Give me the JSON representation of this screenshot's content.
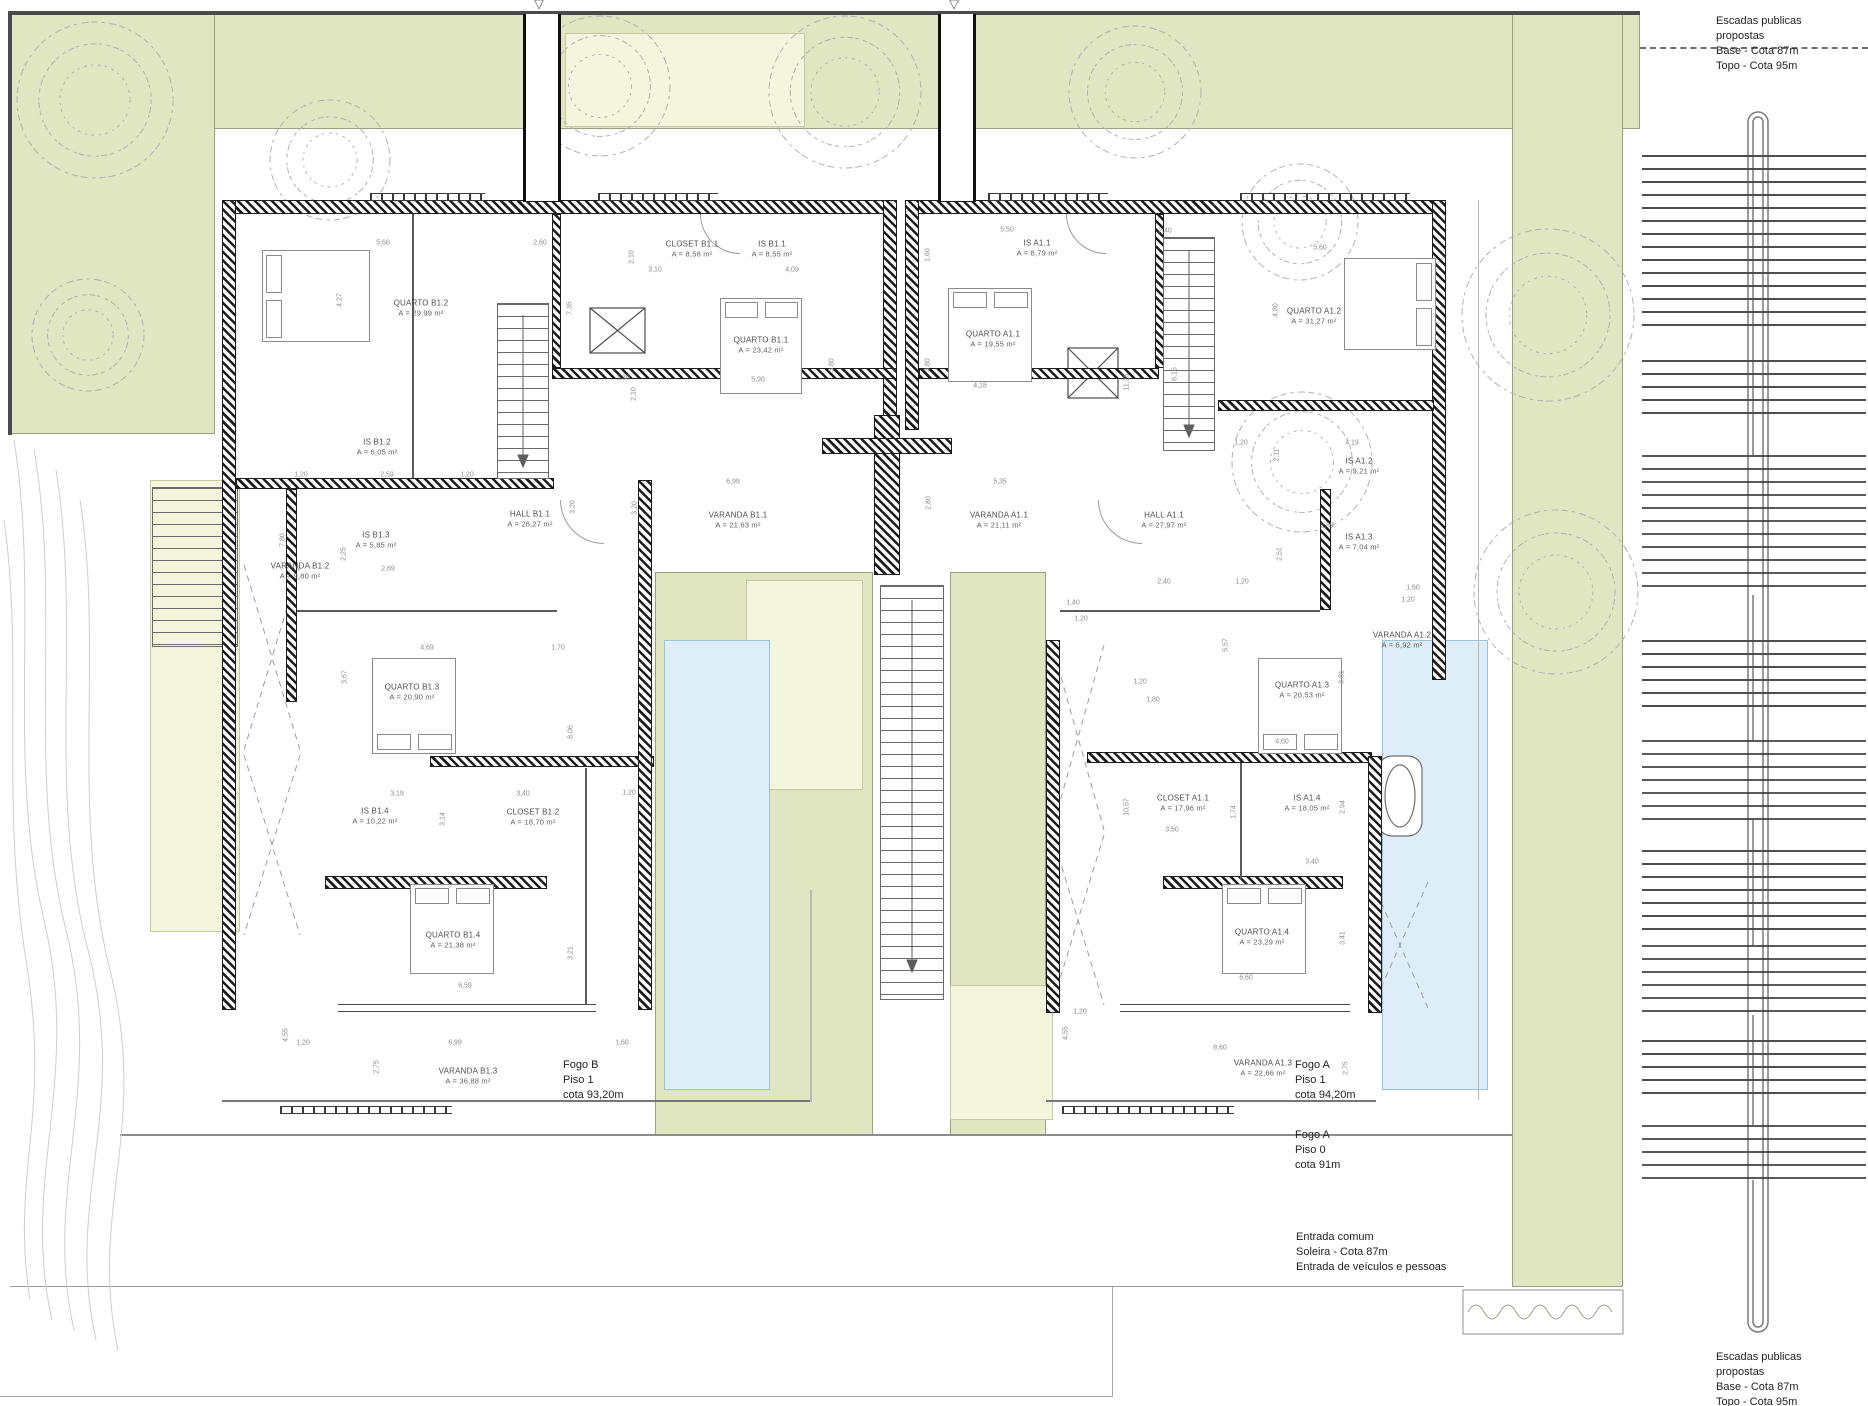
{
  "colors": {
    "garden_green": "#e0e5c2",
    "pale_green": "#f3f5dc",
    "pool_blue": "#ddeef8",
    "wall_dark": "#1d1d1d",
    "line_gray": "#6a6a6a",
    "text_gray": "#4e4e4e"
  },
  "notes": [
    {
      "id": "stairs-note-top-right",
      "x": 1716,
      "y": 14,
      "lines": [
        "Escadas publicas",
        "propostas",
        "Base - Cota 87m",
        "Topo - Cota 95m"
      ]
    },
    {
      "id": "stairs-note-bottom-right",
      "x": 1716,
      "y": 1350,
      "lines": [
        "Escadas publicas",
        "propostas",
        "Base - Cota 87m",
        "Topo - Cota 95m"
      ]
    },
    {
      "id": "fogo-b-piso-1",
      "x": 563,
      "y": 1058,
      "lines": [
        "Fogo B",
        "Piso 1",
        "cota 93,20m"
      ]
    },
    {
      "id": "fogo-a-piso-1",
      "x": 1295,
      "y": 1058,
      "lines": [
        "Fogo A",
        "Piso 1",
        "cota 94,20m"
      ]
    },
    {
      "id": "fogo-a-piso-0",
      "x": 1295,
      "y": 1128,
      "lines": [
        "Fogo A",
        "Piso 0",
        "cota 91m"
      ]
    },
    {
      "id": "entrada-comum",
      "x": 1296,
      "y": 1230,
      "lines": [
        "Entrada comum",
        "Soleira - Cota 87m",
        "Entrada de veículos e pessoas"
      ]
    }
  ],
  "rooms": [
    {
      "name": "QUARTO B1.2",
      "area": "A = 29,99 m²",
      "x": 421,
      "y": 308
    },
    {
      "name": "CLOSET B1.1",
      "area": "A = 8,56 m²",
      "x": 692,
      "y": 249
    },
    {
      "name": "IS B1.1",
      "area": "A = 8,55 m²",
      "x": 772,
      "y": 249
    },
    {
      "name": "QUARTO B1.1",
      "area": "A = 23,42 m²",
      "x": 761,
      "y": 345
    },
    {
      "name": "IS B1.2",
      "area": "A = 6,05 m²",
      "x": 377,
      "y": 447
    },
    {
      "name": "IS B1.3",
      "area": "A = 5,85 m²",
      "x": 376,
      "y": 540
    },
    {
      "name": "VARANDA B1.2",
      "area": "A = 9,80 m²",
      "x": 300,
      "y": 571
    },
    {
      "name": "HALL B1.1",
      "area": "A = 26,27 m²",
      "x": 530,
      "y": 519
    },
    {
      "name": "VARANDA B1.1",
      "area": "A = 21,63 m²",
      "x": 738,
      "y": 520
    },
    {
      "name": "QUARTO B1.3",
      "area": "A = 20,90 m²",
      "x": 412,
      "y": 692
    },
    {
      "name": "IS B1.4",
      "area": "A = 10,22 m²",
      "x": 375,
      "y": 816
    },
    {
      "name": "CLOSET B1.2",
      "area": "A = 18,70 m²",
      "x": 533,
      "y": 817
    },
    {
      "name": "QUARTO B1.4",
      "area": "A = 21,38 m²",
      "x": 453,
      "y": 940
    },
    {
      "name": "VARANDA B1.3",
      "area": "A = 36,88 m²",
      "x": 468,
      "y": 1076
    },
    {
      "name": "IS A1.1",
      "area": "A = 8,79 m²",
      "x": 1037,
      "y": 248
    },
    {
      "name": "QUARTO A1.1",
      "area": "A = 19,55 m²",
      "x": 993,
      "y": 339
    },
    {
      "name": "QUARTO A1.2",
      "area": "A = 31,27 m²",
      "x": 1314,
      "y": 316
    },
    {
      "name": "IS A1.2",
      "area": "A = 9,21 m²",
      "x": 1359,
      "y": 466
    },
    {
      "name": "HALL A1.1",
      "area": "A = 27,97 m²",
      "x": 1164,
      "y": 520
    },
    {
      "name": "VARANDA A1.1",
      "area": "A = 21,11 m²",
      "x": 999,
      "y": 520
    },
    {
      "name": "IS A1.3",
      "area": "A = 7,04 m²",
      "x": 1359,
      "y": 542
    },
    {
      "name": "VARANDA A1.2",
      "area": "A = 6,92 m²",
      "x": 1402,
      "y": 640
    },
    {
      "name": "QUARTO A1.3",
      "area": "A = 20,53 m²",
      "x": 1302,
      "y": 690
    },
    {
      "name": "CLOSET A1.1",
      "area": "A = 17,96 m²",
      "x": 1183,
      "y": 803
    },
    {
      "name": "IS A1.4",
      "area": "A = 18,05 m²",
      "x": 1307,
      "y": 803
    },
    {
      "name": "QUARTO A1.4",
      "area": "A = 23,29 m²",
      "x": 1262,
      "y": 937
    },
    {
      "name": "VARANDA A1.3",
      "area": "A = 22,66 m²",
      "x": 1263,
      "y": 1068
    }
  ],
  "dims": [
    {
      "t": "5,60",
      "x": 383,
      "y": 243
    },
    {
      "t": "2,60",
      "x": 540,
      "y": 243
    },
    {
      "t": "3,10",
      "x": 655,
      "y": 270
    },
    {
      "t": "4,09",
      "x": 792,
      "y": 270
    },
    {
      "t": "2,10",
      "x": 632,
      "y": 257,
      "v": true
    },
    {
      "t": "4,27",
      "x": 340,
      "y": 300,
      "v": true
    },
    {
      "t": "7,35",
      "x": 570,
      "y": 308,
      "v": true
    },
    {
      "t": "5,90",
      "x": 758,
      "y": 380
    },
    {
      "t": "3,80",
      "x": 832,
      "y": 365,
      "v": true
    },
    {
      "t": "1,30",
      "x": 623,
      "y": 378
    },
    {
      "t": "2,10",
      "x": 634,
      "y": 394,
      "v": true
    },
    {
      "t": "5,50",
      "x": 1007,
      "y": 230
    },
    {
      "t": "2,40",
      "x": 1165,
      "y": 231
    },
    {
      "t": "1,60",
      "x": 928,
      "y": 255,
      "v": true
    },
    {
      "t": "4,18",
      "x": 980,
      "y": 386
    },
    {
      "t": "3,80",
      "x": 928,
      "y": 365,
      "v": true
    },
    {
      "t": "11,25",
      "x": 1127,
      "y": 382,
      "v": true
    },
    {
      "t": "6,15",
      "x": 1175,
      "y": 374,
      "v": true
    },
    {
      "t": "5,60",
      "x": 1320,
      "y": 248
    },
    {
      "t": "4,80",
      "x": 1276,
      "y": 310,
      "v": true
    },
    {
      "t": "1,20",
      "x": 1241,
      "y": 443
    },
    {
      "t": "4,19",
      "x": 1352,
      "y": 443
    },
    {
      "t": "2,11",
      "x": 1277,
      "y": 455,
      "v": true
    },
    {
      "t": "1,20",
      "x": 301,
      "y": 475
    },
    {
      "t": "2,59",
      "x": 387,
      "y": 475
    },
    {
      "t": "1,20",
      "x": 467,
      "y": 475
    },
    {
      "t": "3,20",
      "x": 573,
      "y": 507,
      "v": true
    },
    {
      "t": "3,20",
      "x": 635,
      "y": 508,
      "v": true
    },
    {
      "t": "2,25",
      "x": 344,
      "y": 554,
      "v": true
    },
    {
      "t": "2,69",
      "x": 388,
      "y": 569
    },
    {
      "t": "7,80",
      "x": 283,
      "y": 540,
      "v": true
    },
    {
      "t": "4,69",
      "x": 427,
      "y": 648
    },
    {
      "t": "1,70",
      "x": 558,
      "y": 648
    },
    {
      "t": "6,99",
      "x": 733,
      "y": 482
    },
    {
      "t": "5,35",
      "x": 1000,
      "y": 482
    },
    {
      "t": "2,80",
      "x": 929,
      "y": 503,
      "v": true
    },
    {
      "t": "2,40",
      "x": 1164,
      "y": 582
    },
    {
      "t": "1,20",
      "x": 1242,
      "y": 582
    },
    {
      "t": "1,40",
      "x": 1073,
      "y": 603
    },
    {
      "t": "1,20",
      "x": 1081,
      "y": 619
    },
    {
      "t": "2,89",
      "x": 1327,
      "y": 526
    },
    {
      "t": "2,51",
      "x": 1280,
      "y": 554,
      "v": true
    },
    {
      "t": "5,57",
      "x": 1226,
      "y": 645,
      "v": true
    },
    {
      "t": "1,60",
      "x": 1413,
      "y": 588
    },
    {
      "t": "1,20",
      "x": 1408,
      "y": 600
    },
    {
      "t": "3,67",
      "x": 345,
      "y": 677,
      "v": true
    },
    {
      "t": "8,06",
      "x": 571,
      "y": 732,
      "v": true
    },
    {
      "t": "3,19",
      "x": 397,
      "y": 794
    },
    {
      "t": "3,40",
      "x": 523,
      "y": 794
    },
    {
      "t": "1,20",
      "x": 629,
      "y": 793
    },
    {
      "t": "3,14",
      "x": 443,
      "y": 819,
      "v": true
    },
    {
      "t": "6,59",
      "x": 465,
      "y": 986
    },
    {
      "t": "3,21",
      "x": 571,
      "y": 953,
      "v": true
    },
    {
      "t": "1,20",
      "x": 303,
      "y": 1043
    },
    {
      "t": "6,99",
      "x": 455,
      "y": 1043
    },
    {
      "t": "1,60",
      "x": 622,
      "y": 1043
    },
    {
      "t": "2,75",
      "x": 377,
      "y": 1067,
      "v": true
    },
    {
      "t": "4,55",
      "x": 286,
      "y": 1035,
      "v": true
    },
    {
      "t": "1,20",
      "x": 1140,
      "y": 682
    },
    {
      "t": "1,80",
      "x": 1153,
      "y": 700
    },
    {
      "t": "4,60",
      "x": 1282,
      "y": 742
    },
    {
      "t": "3,81",
      "x": 1342,
      "y": 677,
      "v": true
    },
    {
      "t": "10,57",
      "x": 1127,
      "y": 807,
      "v": true
    },
    {
      "t": "3,50",
      "x": 1172,
      "y": 830
    },
    {
      "t": "1,74",
      "x": 1234,
      "y": 812,
      "v": true
    },
    {
      "t": "3,40",
      "x": 1312,
      "y": 862
    },
    {
      "t": "2,94",
      "x": 1343,
      "y": 807,
      "v": true
    },
    {
      "t": "6,60",
      "x": 1246,
      "y": 978
    },
    {
      "t": "8,60",
      "x": 1220,
      "y": 1048
    },
    {
      "t": "1,20",
      "x": 1080,
      "y": 1012
    },
    {
      "t": "4,55",
      "x": 1066,
      "y": 1033,
      "v": true
    },
    {
      "t": "3,41",
      "x": 1343,
      "y": 938,
      "v": true
    },
    {
      "t": "2,75",
      "x": 1346,
      "y": 1068,
      "v": true
    }
  ],
  "beds": [
    {
      "x": 262,
      "y": 250,
      "w": 108,
      "h": 92,
      "head": "left"
    },
    {
      "x": 720,
      "y": 298,
      "w": 82,
      "h": 96,
      "head": "top"
    },
    {
      "x": 948,
      "y": 288,
      "w": 84,
      "h": 94,
      "head": "top"
    },
    {
      "x": 1344,
      "y": 258,
      "w": 92,
      "h": 92,
      "head": "right"
    },
    {
      "x": 372,
      "y": 658,
      "w": 84,
      "h": 96,
      "head": "bottom"
    },
    {
      "x": 1258,
      "y": 658,
      "w": 84,
      "h": 96,
      "head": "bottom"
    },
    {
      "x": 410,
      "y": 884,
      "w": 84,
      "h": 90,
      "head": "top"
    },
    {
      "x": 1222,
      "y": 884,
      "w": 84,
      "h": 90,
      "head": "top"
    }
  ],
  "trees": [
    {
      "x": 95,
      "y": 100,
      "r": 78
    },
    {
      "x": 330,
      "y": 160,
      "r": 60
    },
    {
      "x": 88,
      "y": 335,
      "r": 56
    },
    {
      "x": 600,
      "y": 86,
      "r": 70
    },
    {
      "x": 845,
      "y": 92,
      "r": 76
    },
    {
      "x": 1135,
      "y": 92,
      "r": 66
    },
    {
      "x": 1300,
      "y": 222,
      "r": 58
    },
    {
      "x": 1548,
      "y": 315,
      "r": 86
    },
    {
      "x": 1302,
      "y": 462,
      "r": 70
    },
    {
      "x": 1556,
      "y": 592,
      "r": 82
    }
  ],
  "fixtures": {
    "bathtub": {
      "x": 1378,
      "y": 756,
      "w": 44,
      "h": 80
    }
  }
}
